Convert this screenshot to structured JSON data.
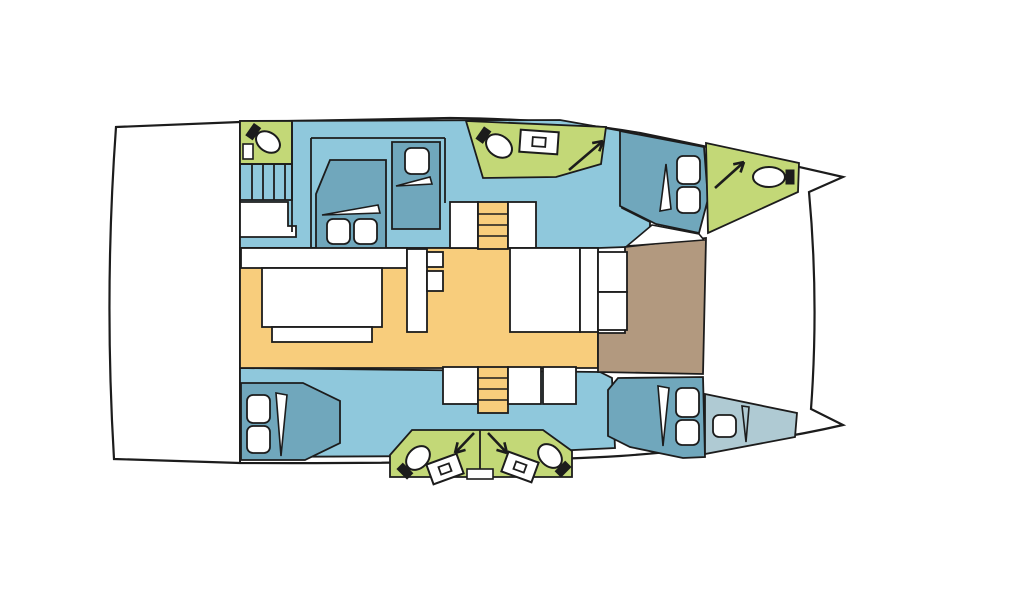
{
  "canvas": {
    "width": 1024,
    "height": 600,
    "background": "#FFFFFF"
  },
  "palette": {
    "white": "#FFFFFF",
    "outline": "#1C1C1C",
    "hull_floor": "#8FC8DC",
    "cabin": "#70A7BC",
    "bathroom": "#C3D877",
    "saloon": "#F8CD7C",
    "foredeck": "#B2997F",
    "forepeak": "#AFCAD3"
  },
  "figure": {
    "type": "boat-floor-plan",
    "subject": "catamaran-interior-deck-layout",
    "rooms": [
      "aft-deck",
      "saloon",
      "galley",
      "foredeck-lounge",
      "cabin-top-master",
      "cabin-top-single",
      "cabin-bow-top",
      "cabin-aft-bottom",
      "cabin-bow-bottom",
      "forepeak-berth",
      "head-top-left",
      "head-top-center",
      "head-bow-top",
      "head-bottom-left",
      "head-bottom-right"
    ]
  },
  "shapes": [
    {
      "name": "hull-outline",
      "kind": "path",
      "fill": "$white",
      "sw": 2.2,
      "d": "M116,127 L240,122 L450,118 Q560,119 640,133 Q748,155 843,177 L809,192 Q819,300 811,409 L843,425 Q748,447 620,456 Q480,464 240,463 L114,459 Q104,293 116,127 Z"
    },
    {
      "name": "stern-bulkhead-line",
      "kind": "line",
      "x1": 240,
      "y1": 122,
      "x2": 240,
      "y2": 463,
      "sw": 2
    },
    {
      "name": "hull-top-floor",
      "kind": "polygon",
      "fill": "$hull_floor",
      "sw": 1.8,
      "pts": [
        [
          240,
          121
        ],
        [
          560,
          120
        ],
        [
          622,
          131
        ],
        [
          622,
          208
        ],
        [
          650,
          222
        ],
        [
          650,
          243
        ],
        [
          626,
          247
        ],
        [
          598,
          248
        ],
        [
          240,
          248
        ]
      ]
    },
    {
      "name": "hull-bottom-floor",
      "kind": "polygon",
      "fill": "$hull_floor",
      "sw": 1.8,
      "pts": [
        [
          240,
          368
        ],
        [
          600,
          372
        ],
        [
          612,
          378
        ],
        [
          615,
          448
        ],
        [
          450,
          456
        ],
        [
          240,
          457
        ]
      ]
    },
    {
      "name": "saloon-floor",
      "kind": "polygon",
      "fill": "$saloon",
      "sw": 1.8,
      "pts": [
        [
          240,
          248
        ],
        [
          598,
          248
        ],
        [
          598,
          368
        ],
        [
          240,
          368
        ]
      ]
    },
    {
      "name": "foredeck-lounge",
      "kind": "polygon",
      "fill": "$foredeck",
      "sw": 1.8,
      "pts": [
        [
          625,
          247
        ],
        [
          706,
          238
        ],
        [
          703,
          374
        ],
        [
          598,
          372
        ],
        [
          598,
          333
        ],
        [
          625,
          333
        ]
      ]
    },
    {
      "name": "head-top-left-floor",
      "kind": "polygon",
      "fill": "$bathroom",
      "sw": 1.8,
      "pts": [
        [
          240,
          121
        ],
        [
          292,
          121
        ],
        [
          292,
          164
        ],
        [
          240,
          164
        ]
      ]
    },
    {
      "name": "head-top-left-sink",
      "kind": "rect",
      "fill": "$white",
      "sw": 1.6,
      "x": 243,
      "y": 144,
      "w": 10,
      "h": 15
    },
    {
      "name": "head-top-left-toilet",
      "kind": "toilet",
      "cx": 268,
      "cy": 142,
      "deg": 35,
      "rx": 13,
      "ry": 9.5
    },
    {
      "name": "entry-stairs-top-box",
      "kind": "rect",
      "fill": "none",
      "sw": 1.8,
      "x": 240,
      "y": 164,
      "w": 52,
      "h": 36
    },
    {
      "name": "entry-stairs-top-steps",
      "kind": "lines",
      "sw": 1.8,
      "segs": [
        [
          252,
          164,
          252,
          200
        ],
        [
          263,
          164,
          263,
          200
        ],
        [
          274,
          164,
          274,
          200
        ],
        [
          285,
          164,
          285,
          200
        ]
      ]
    },
    {
      "name": "counter-top-left",
      "kind": "polygon",
      "fill": "$white",
      "sw": 1.8,
      "pts": [
        [
          240,
          202
        ],
        [
          288,
          202
        ],
        [
          288,
          226
        ],
        [
          296,
          226
        ],
        [
          296,
          237
        ],
        [
          240,
          237
        ]
      ]
    },
    {
      "name": "cabin-walls-top",
      "kind": "lines",
      "sw": 1.8,
      "segs": [
        [
          292,
          122,
          292,
          232
        ],
        [
          311,
          138,
          311,
          250
        ],
        [
          311,
          138,
          445,
          138
        ],
        [
          445,
          138,
          445,
          203
        ]
      ]
    },
    {
      "name": "master-bed",
      "kind": "polygon",
      "fill": "$cabin",
      "sw": 1.8,
      "pts": [
        [
          316,
          194
        ],
        [
          330,
          160
        ],
        [
          386,
          160
        ],
        [
          386,
          249
        ],
        [
          316,
          249
        ]
      ]
    },
    {
      "name": "master-bed-blanket",
      "kind": "polygon",
      "fill": "$white",
      "sw": 1.6,
      "pts": [
        [
          322,
          215
        ],
        [
          378,
          205
        ],
        [
          380,
          213
        ]
      ]
    },
    {
      "name": "master-bed-pillow-left",
      "kind": "rrect",
      "fill": "$white",
      "sw": 1.8,
      "x": 327,
      "y": 219,
      "w": 23,
      "h": 25,
      "rx": 6
    },
    {
      "name": "master-bed-pillow-right",
      "kind": "rrect",
      "fill": "$white",
      "sw": 1.8,
      "x": 354,
      "y": 219,
      "w": 23,
      "h": 25,
      "rx": 6
    },
    {
      "name": "single-berth-top",
      "kind": "polygon",
      "fill": "$cabin",
      "sw": 1.8,
      "pts": [
        [
          392,
          142
        ],
        [
          440,
          142
        ],
        [
          440,
          229
        ],
        [
          392,
          229
        ]
      ]
    },
    {
      "name": "single-berth-top-blanket",
      "kind": "polygon",
      "fill": "$white",
      "sw": 1.6,
      "pts": [
        [
          396,
          186
        ],
        [
          430,
          177
        ],
        [
          432,
          184
        ]
      ]
    },
    {
      "name": "single-berth-top-pillow",
      "kind": "rrect",
      "fill": "$white",
      "sw": 1.8,
      "x": 405,
      "y": 148,
      "w": 24,
      "h": 26,
      "rx": 6
    },
    {
      "name": "stairs-top-landing-left",
      "kind": "rect",
      "fill": "$white",
      "sw": 1.8,
      "x": 450,
      "y": 202,
      "w": 28,
      "h": 46
    },
    {
      "name": "stairs-top-flight",
      "kind": "rect",
      "fill": "$saloon",
      "sw": 1.8,
      "x": 478,
      "y": 202,
      "w": 30,
      "h": 47
    },
    {
      "name": "stairs-top-landing-right",
      "kind": "rect",
      "fill": "$white",
      "sw": 1.8,
      "x": 508,
      "y": 202,
      "w": 28,
      "h": 46
    },
    {
      "name": "stairs-top-steps",
      "kind": "lines",
      "sw": 1.6,
      "segs": [
        [
          478,
          214,
          508,
          214
        ],
        [
          478,
          225,
          508,
          225
        ],
        [
          478,
          236,
          508,
          236
        ]
      ]
    },
    {
      "name": "head-top-center-floor",
      "kind": "polygon",
      "fill": "$bathroom",
      "sw": 1.8,
      "pts": [
        [
          466,
          121
        ],
        [
          606,
          127
        ],
        [
          601,
          164
        ],
        [
          556,
          177
        ],
        [
          483,
          178
        ]
      ]
    },
    {
      "name": "head-top-center-toilet",
      "kind": "toilet",
      "cx": 499,
      "cy": 146,
      "deg": 35,
      "rx": 14,
      "ry": 10.5
    },
    {
      "name": "head-top-center-sink",
      "kind": "sink",
      "cx": 539,
      "cy": 142,
      "w": 38,
      "h": 22,
      "deg": 4,
      "iw": 13,
      "ih": 9
    },
    {
      "name": "head-top-center-arrow",
      "kind": "arrow",
      "x1": 569,
      "y1": 170,
      "x2": 603,
      "y2": 141,
      "sw": 2.6
    },
    {
      "name": "cabin-bow-top-bed",
      "kind": "polygon",
      "fill": "$cabin",
      "sw": 1.8,
      "pts": [
        [
          620,
          131
        ],
        [
          704,
          147
        ],
        [
          708,
          199
        ],
        [
          699,
          233
        ],
        [
          656,
          224
        ],
        [
          620,
          206
        ]
      ]
    },
    {
      "name": "cabin-bow-top-blanket",
      "kind": "polygon",
      "fill": "$white",
      "sw": 1.6,
      "pts": [
        [
          660,
          211
        ],
        [
          666,
          164
        ],
        [
          671,
          209
        ]
      ]
    },
    {
      "name": "cabin-bow-top-pillow-1",
      "kind": "rrect",
      "fill": "$white",
      "sw": 1.8,
      "x": 677,
      "y": 156,
      "w": 23,
      "h": 28,
      "rx": 6
    },
    {
      "name": "cabin-bow-top-pillow-2",
      "kind": "rrect",
      "fill": "$white",
      "sw": 1.8,
      "x": 677,
      "y": 187,
      "w": 23,
      "h": 26,
      "rx": 6
    },
    {
      "name": "side-deck-step-top",
      "kind": "polygon",
      "fill": "$white",
      "sw": 1.6,
      "pts": [
        [
          652,
          225
        ],
        [
          699,
          234
        ],
        [
          704,
          240
        ],
        [
          627,
          246
        ]
      ]
    },
    {
      "name": "head-bow-top-floor",
      "kind": "polygon",
      "fill": "$bathroom",
      "sw": 1.8,
      "pts": [
        [
          706,
          143
        ],
        [
          799,
          163
        ],
        [
          798,
          192
        ],
        [
          708,
          233
        ]
      ]
    },
    {
      "name": "head-bow-top-arrow",
      "kind": "arrow",
      "x1": 715,
      "y1": 188,
      "x2": 744,
      "y2": 162,
      "sw": 2.6
    },
    {
      "name": "head-bow-top-toilet",
      "kind": "toilet",
      "cx": 769,
      "cy": 177,
      "deg": 180,
      "rx": 16,
      "ry": 10
    },
    {
      "name": "saloon-sofa",
      "kind": "rect",
      "fill": "$white",
      "sw": 1.8,
      "x": 241,
      "y": 248,
      "w": 166,
      "h": 20
    },
    {
      "name": "saloon-table",
      "kind": "rect",
      "fill": "$white",
      "sw": 1.8,
      "x": 262,
      "y": 268,
      "w": 120,
      "h": 59
    },
    {
      "name": "saloon-bench",
      "kind": "rect",
      "fill": "$white",
      "sw": 1.8,
      "x": 272,
      "y": 327,
      "w": 100,
      "h": 15
    },
    {
      "name": "saloon-counter-right",
      "kind": "rect",
      "fill": "$white",
      "sw": 1.8,
      "x": 407,
      "y": 249,
      "w": 20,
      "h": 83
    },
    {
      "name": "saloon-counter-compartment-1",
      "kind": "rect",
      "fill": "$white",
      "sw": 1.8,
      "x": 427,
      "y": 252,
      "w": 16,
      "h": 15
    },
    {
      "name": "saloon-counter-compartment-2",
      "kind": "rect",
      "fill": "$white",
      "sw": 1.8,
      "x": 427,
      "y": 271,
      "w": 16,
      "h": 20
    },
    {
      "name": "galley-block-left",
      "kind": "rect",
      "fill": "$white",
      "sw": 1.8,
      "x": 510,
      "y": 248,
      "w": 70,
      "h": 84
    },
    {
      "name": "galley-block-mid",
      "kind": "rect",
      "fill": "$white",
      "sw": 1.8,
      "x": 580,
      "y": 248,
      "w": 18,
      "h": 84
    },
    {
      "name": "galley-unit-top",
      "kind": "rect",
      "fill": "$white",
      "sw": 1.8,
      "x": 598,
      "y": 252,
      "w": 29,
      "h": 40
    },
    {
      "name": "galley-unit-bottom",
      "kind": "rect",
      "fill": "$white",
      "sw": 1.8,
      "x": 598,
      "y": 292,
      "w": 29,
      "h": 38
    },
    {
      "name": "stairs-bottom-landing-left",
      "kind": "rect",
      "fill": "$white",
      "sw": 1.8,
      "x": 443,
      "y": 367,
      "w": 35,
      "h": 37
    },
    {
      "name": "stairs-bottom-flight",
      "kind": "rect",
      "fill": "$saloon",
      "sw": 1.8,
      "x": 478,
      "y": 367,
      "w": 30,
      "h": 46
    },
    {
      "name": "stairs-bottom-landing-mid",
      "kind": "rect",
      "fill": "$white",
      "sw": 1.8,
      "x": 508,
      "y": 367,
      "w": 33,
      "h": 37
    },
    {
      "name": "stairs-bottom-landing-right",
      "kind": "rect",
      "fill": "$white",
      "sw": 1.8,
      "x": 543,
      "y": 367,
      "w": 33,
      "h": 37
    },
    {
      "name": "stairs-bottom-steps",
      "kind": "lines",
      "sw": 1.6,
      "segs": [
        [
          478,
          378,
          508,
          378
        ],
        [
          478,
          389,
          508,
          389
        ],
        [
          478,
          400,
          508,
          400
        ]
      ]
    },
    {
      "name": "cabin-aft-bottom-bed",
      "kind": "polygon",
      "fill": "$cabin",
      "sw": 1.8,
      "pts": [
        [
          241,
          383
        ],
        [
          303,
          383
        ],
        [
          340,
          401
        ],
        [
          340,
          443
        ],
        [
          305,
          460
        ],
        [
          241,
          460
        ]
      ]
    },
    {
      "name": "cabin-aft-bottom-blanket",
      "kind": "polygon",
      "fill": "$white",
      "sw": 1.6,
      "pts": [
        [
          276,
          393
        ],
        [
          281,
          456
        ],
        [
          287,
          395
        ]
      ]
    },
    {
      "name": "cabin-aft-bottom-pillow-1",
      "kind": "rrect",
      "fill": "$white",
      "sw": 1.8,
      "x": 247,
      "y": 395,
      "w": 23,
      "h": 28,
      "rx": 6
    },
    {
      "name": "cabin-aft-bottom-pillow-2",
      "kind": "rrect",
      "fill": "$white",
      "sw": 1.8,
      "x": 247,
      "y": 426,
      "w": 23,
      "h": 27,
      "rx": 6
    },
    {
      "name": "heads-bottom-floor",
      "kind": "polygon",
      "fill": "$bathroom",
      "sw": 1.8,
      "pts": [
        [
          390,
          455
        ],
        [
          412,
          430
        ],
        [
          543,
          430
        ],
        [
          572,
          451
        ],
        [
          572,
          477
        ],
        [
          390,
          477
        ]
      ]
    },
    {
      "name": "heads-bottom-divider",
      "kind": "line",
      "x1": 480,
      "y1": 430,
      "x2": 480,
      "y2": 477,
      "sw": 1.8
    },
    {
      "name": "heads-bottom-door-notch",
      "kind": "rect",
      "fill": "$white",
      "sw": 1.6,
      "x": 467,
      "y": 469,
      "w": 26,
      "h": 10
    },
    {
      "name": "head-bottom-left-arrow",
      "kind": "arrow",
      "x1": 474,
      "y1": 433,
      "x2": 455,
      "y2": 453,
      "sw": 2.6
    },
    {
      "name": "head-bottom-right-arrow",
      "kind": "arrow",
      "x1": 488,
      "y1": 433,
      "x2": 507,
      "y2": 453,
      "sw": 2.6
    },
    {
      "name": "head-bottom-left-toilet",
      "kind": "toilet",
      "cx": 418,
      "cy": 458,
      "deg": -45,
      "rx": 13.5,
      "ry": 10
    },
    {
      "name": "head-bottom-right-toilet",
      "kind": "toilet",
      "cx": 550,
      "cy": 456,
      "deg": -135,
      "rx": 13.5,
      "ry": 10
    },
    {
      "name": "head-bottom-left-sink",
      "kind": "sink",
      "cx": 445,
      "cy": 469,
      "w": 32,
      "h": 21,
      "deg": -20,
      "iw": 11,
      "ih": 8
    },
    {
      "name": "head-bottom-right-sink",
      "kind": "sink",
      "cx": 520,
      "cy": 467,
      "w": 32,
      "h": 21,
      "deg": 20,
      "iw": 11,
      "ih": 8
    },
    {
      "name": "cabin-bow-bottom-bed",
      "kind": "polygon",
      "fill": "$cabin",
      "sw": 1.8,
      "pts": [
        [
          608,
          390
        ],
        [
          618,
          378
        ],
        [
          703,
          377
        ],
        [
          705,
          457
        ],
        [
          683,
          458
        ],
        [
          630,
          447
        ],
        [
          608,
          436
        ]
      ]
    },
    {
      "name": "cabin-bow-bottom-blanket",
      "kind": "polygon",
      "fill": "$white",
      "sw": 1.6,
      "pts": [
        [
          658,
          386
        ],
        [
          663,
          446
        ],
        [
          669,
          388
        ]
      ]
    },
    {
      "name": "cabin-bow-bottom-pillow-1",
      "kind": "rrect",
      "fill": "$white",
      "sw": 1.8,
      "x": 676,
      "y": 388,
      "w": 23,
      "h": 29,
      "rx": 6
    },
    {
      "name": "cabin-bow-bottom-pillow-2",
      "kind": "rrect",
      "fill": "$white",
      "sw": 1.8,
      "x": 676,
      "y": 420,
      "w": 23,
      "h": 25,
      "rx": 6
    },
    {
      "name": "forepeak-berth",
      "kind": "polygon",
      "fill": "$forepeak",
      "sw": 1.8,
      "pts": [
        [
          705,
          394
        ],
        [
          797,
          413
        ],
        [
          795,
          437
        ],
        [
          705,
          454
        ]
      ]
    },
    {
      "name": "forepeak-pillow",
      "kind": "rrect",
      "fill": "$white",
      "sw": 1.8,
      "x": 713,
      "y": 415,
      "w": 23,
      "h": 22,
      "rx": 6
    },
    {
      "name": "forepeak-blanket",
      "kind": "polygon",
      "fill": "none",
      "sw": 1.6,
      "pts": [
        [
          742,
          406
        ],
        [
          746,
          442
        ],
        [
          749,
          407
        ]
      ]
    }
  ]
}
